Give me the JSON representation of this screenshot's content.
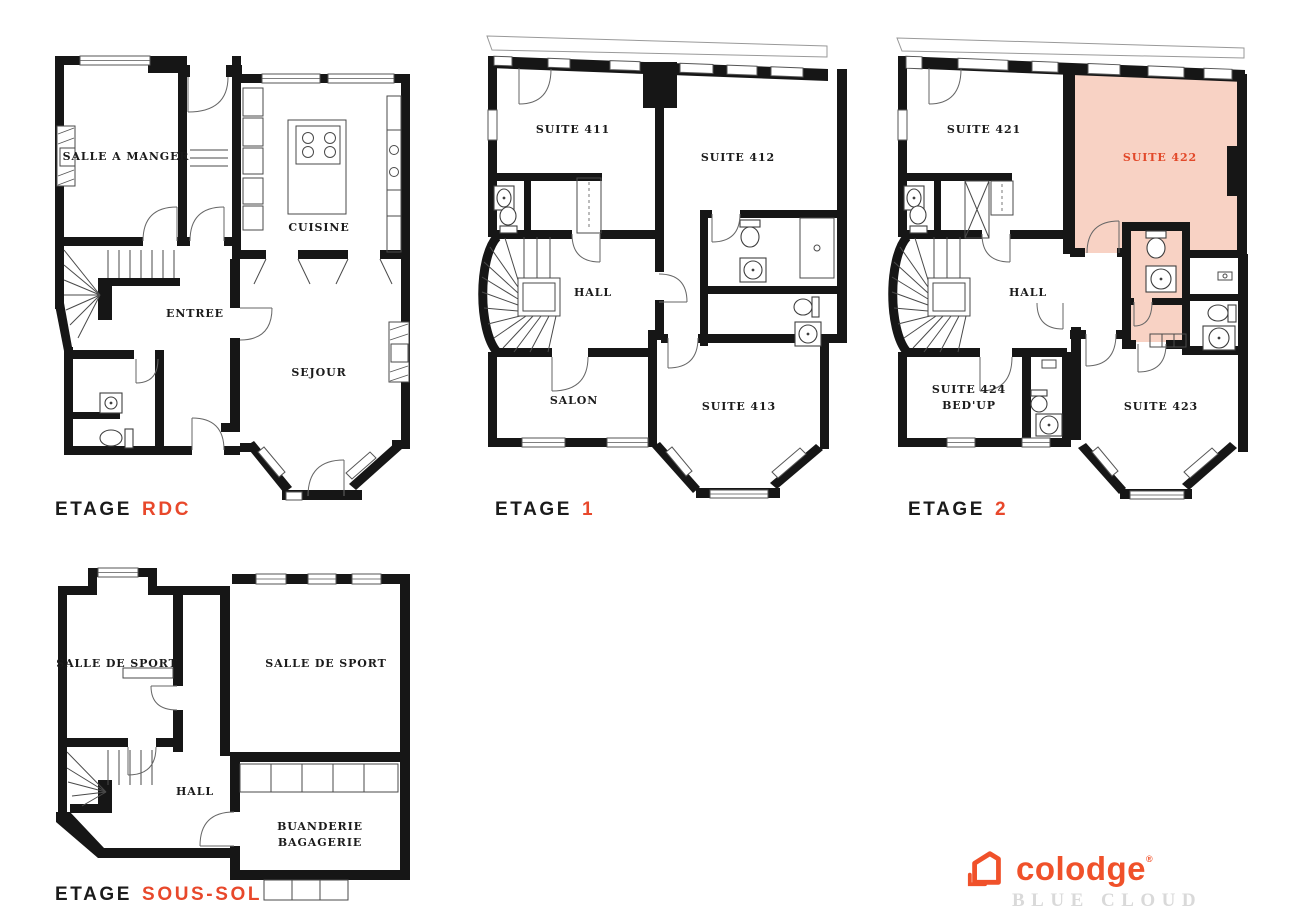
{
  "palette": {
    "wall": "#161616",
    "accent": "#e8482b",
    "suite_highlight_fill": "#f8d2c4",
    "suite_highlight_text": "#e2492a",
    "logo_orange": "#f0512a",
    "logo_gray": "#d9d9d9"
  },
  "floors": [
    {
      "id": "rdc",
      "label": {
        "prefix": "ETAGE",
        "value": "RDC"
      },
      "rooms": [
        {
          "label": "SALLE A MANGER"
        },
        {
          "label": "CUISINE"
        },
        {
          "label": "ENTREE"
        },
        {
          "label": "SEJOUR"
        }
      ]
    },
    {
      "id": "etage-1",
      "label": {
        "prefix": "ETAGE",
        "value": "1"
      },
      "rooms": [
        {
          "label": "SUITE 411"
        },
        {
          "label": "SUITE 412"
        },
        {
          "label": "HALL"
        },
        {
          "label": "SALON"
        },
        {
          "label": "SUITE 413"
        }
      ]
    },
    {
      "id": "etage-2",
      "label": {
        "prefix": "ETAGE",
        "value": "2"
      },
      "rooms": [
        {
          "label": "SUITE 421"
        },
        {
          "label": "SUITE 422",
          "highlighted": true
        },
        {
          "label": "HALL"
        },
        {
          "label": "SUITE 424",
          "label2": "BED'UP"
        },
        {
          "label": "SUITE 423"
        }
      ]
    },
    {
      "id": "sous-sol",
      "label": {
        "prefix": "ETAGE",
        "value": "SOUS-SOL"
      },
      "rooms": [
        {
          "label": "SALLE DE SPORT"
        },
        {
          "label": "SALLE DE SPORT"
        },
        {
          "label": "HALL"
        },
        {
          "label": "BUANDERIE",
          "label2": "BAGAGERIE"
        }
      ]
    }
  ],
  "logo": {
    "brand": "colodge",
    "mark": "®",
    "subtitle": "BLUE CLOUD"
  }
}
